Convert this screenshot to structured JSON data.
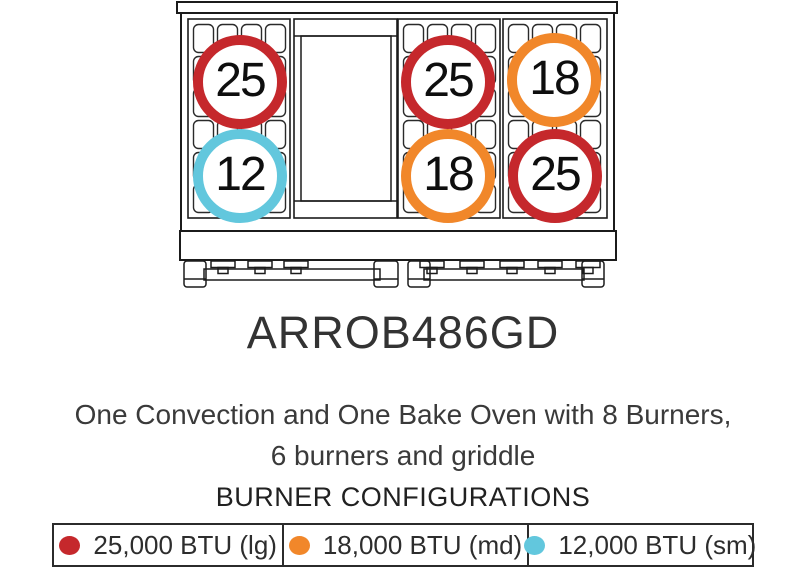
{
  "colors": {
    "lg": "#c5282c",
    "md": "#f1872a",
    "sm": "#62c7dd"
  },
  "diagram": {
    "name": "range-top-line-drawing",
    "griddle_sections": 1,
    "burners": [
      {
        "label": "25",
        "size": "lg",
        "position": "left-top"
      },
      {
        "label": "12",
        "size": "sm",
        "position": "left-bottom"
      },
      {
        "label": "25",
        "size": "lg",
        "position": "center-top"
      },
      {
        "label": "18",
        "size": "md",
        "position": "center-bottom"
      },
      {
        "label": "18",
        "size": "md",
        "position": "right-top"
      },
      {
        "label": "25",
        "size": "lg",
        "position": "right-bottom"
      }
    ]
  },
  "model_number": "ARROB486GD",
  "description": {
    "line1": "One Convection and One Bake Oven with 8 Burners,",
    "line2": "6 burners and griddle"
  },
  "legend": {
    "title": "BURNER CONFIGURATIONS",
    "items": [
      {
        "label": "25,000 BTU (lg)",
        "size": "lg"
      },
      {
        "label": "18,000 BTU (md)",
        "size": "md"
      },
      {
        "label": "12,000 BTU (sm)",
        "size": "sm"
      }
    ]
  }
}
